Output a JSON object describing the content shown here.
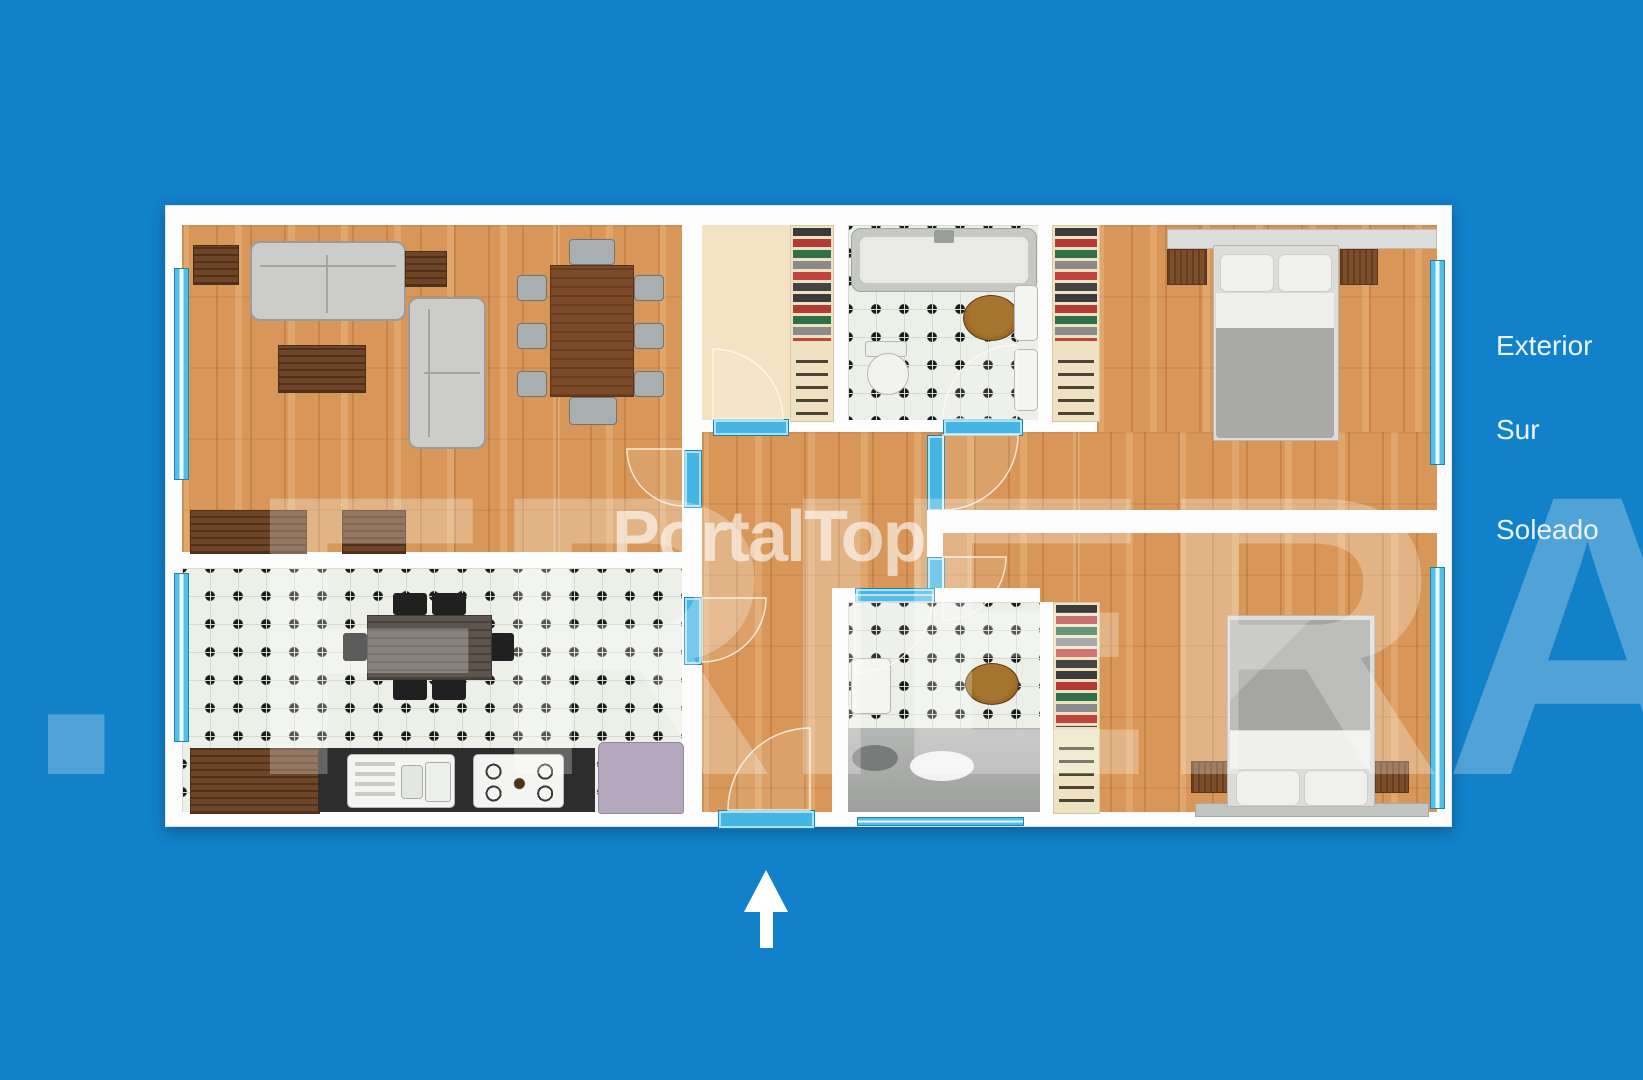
{
  "canvas": {
    "width": 1643,
    "height": 1080,
    "background_color": "#1181c9"
  },
  "watermarks": {
    "center_brand": "PortalTop",
    "agency_background": "H. FRIERA"
  },
  "orientation_labels": [
    {
      "text": "Exterior"
    },
    {
      "text": "Sur"
    },
    {
      "text": "Soleado"
    }
  ],
  "compass": {
    "icon": "north-arrow-icon",
    "direction": "up"
  },
  "floor_plan": {
    "type": "apartment-top-view",
    "rooms": [
      {
        "name": "living-dining-room",
        "floor": "wood",
        "furniture": [
          "three-seat-sofa",
          "two-seat-sofa",
          "coffee-table",
          "side-table",
          "side-table",
          "dining-table",
          "dining-chairs-x8",
          "sideboard",
          "sideboard"
        ]
      },
      {
        "name": "kitchen",
        "floor": "checkered-tile",
        "furniture": [
          "kitchen-table",
          "black-chairs-x6",
          "wood-counter",
          "sink-counter",
          "gas-hob",
          "refrigerator"
        ]
      },
      {
        "name": "entry-dressing-room",
        "floor": "cream",
        "furniture": [
          "wardrobe-clothes-rail"
        ]
      },
      {
        "name": "bathroom-1",
        "floor": "checkered-tile",
        "furniture": [
          "bathtub",
          "toilet",
          "washbasin",
          "wooden-stool"
        ]
      },
      {
        "name": "bedroom-1",
        "floor": "wood",
        "furniture": [
          "double-bed",
          "nightstand",
          "nightstand",
          "headboard-shelf",
          "wardrobe-clothes-rail"
        ]
      },
      {
        "name": "hallway",
        "floor": "wood",
        "furniture": []
      },
      {
        "name": "bathroom-2",
        "floor": "checkered-tile-with-shower",
        "furniture": [
          "washbasin",
          "wooden-stool",
          "walk-in-shower",
          "bath-mat"
        ]
      },
      {
        "name": "bedroom-2",
        "floor": "wood",
        "furniture": [
          "double-bed",
          "nightstand",
          "nightstand",
          "bench-shelf",
          "wardrobe-clothes-rail"
        ]
      }
    ],
    "openings": [
      "windows-left-x2",
      "windows-right-x2",
      "entry-door-bottom",
      "interior-doors-x7"
    ],
    "colors": {
      "background": "#1181c9",
      "walls": "#fdfdfd",
      "wood_floor": "#d89758",
      "tile_base": "#edf0e9",
      "tile_dot": "#1b1b1b",
      "window_blue": "#53bfe9",
      "door_blue": "#45b5e4",
      "shower_gray": "#a8aaa8",
      "fridge_lavender": "#b4a7bd",
      "sofa_gray": "#cccccb",
      "furniture_wood": "#6e4527"
    }
  }
}
